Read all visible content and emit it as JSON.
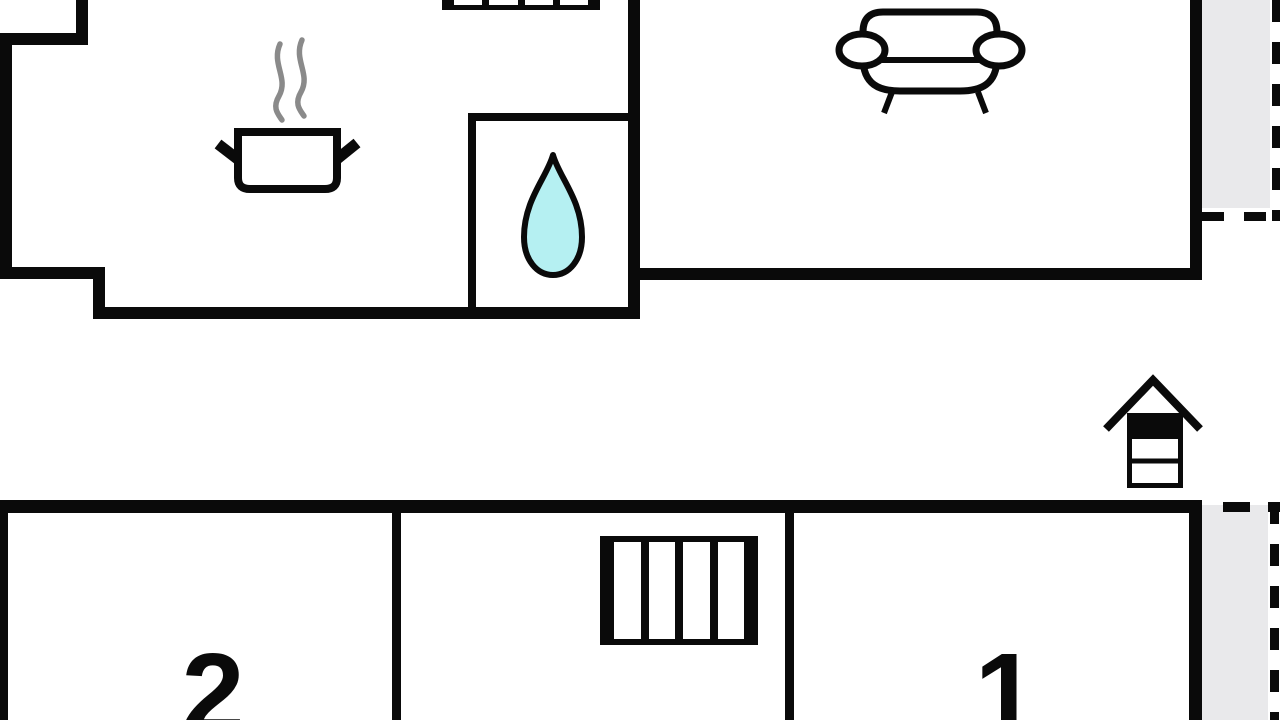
{
  "title": "holiday-home-floor-plan",
  "colors": {
    "background": "#ffffff",
    "walls": "#0a0a0a",
    "terrace_fill": "#e9e9eb",
    "water_drop_fill": "#b5f0f2",
    "steam_gray": "#8a8a8a"
  },
  "upper_floor": {
    "rooms": [
      {
        "id": "kitchen",
        "icon": "cooking-pot-icon",
        "label": ""
      },
      {
        "id": "bathroom",
        "icon": "water-drop-icon",
        "label": ""
      },
      {
        "id": "living-room",
        "icon": "sofa-icon",
        "label": ""
      }
    ],
    "stairs_icon": "stairs-icon",
    "terrace_style": "dashed-outline"
  },
  "lower_floor": {
    "rooms": [
      {
        "id": "room-2",
        "label": "2"
      },
      {
        "id": "stair-hall",
        "icon": "stairs-icon",
        "label": ""
      },
      {
        "id": "room-1",
        "label": "1"
      }
    ],
    "terrace_style": "dashed-outline"
  },
  "exterior": {
    "icon": "wood-stove-icon"
  }
}
